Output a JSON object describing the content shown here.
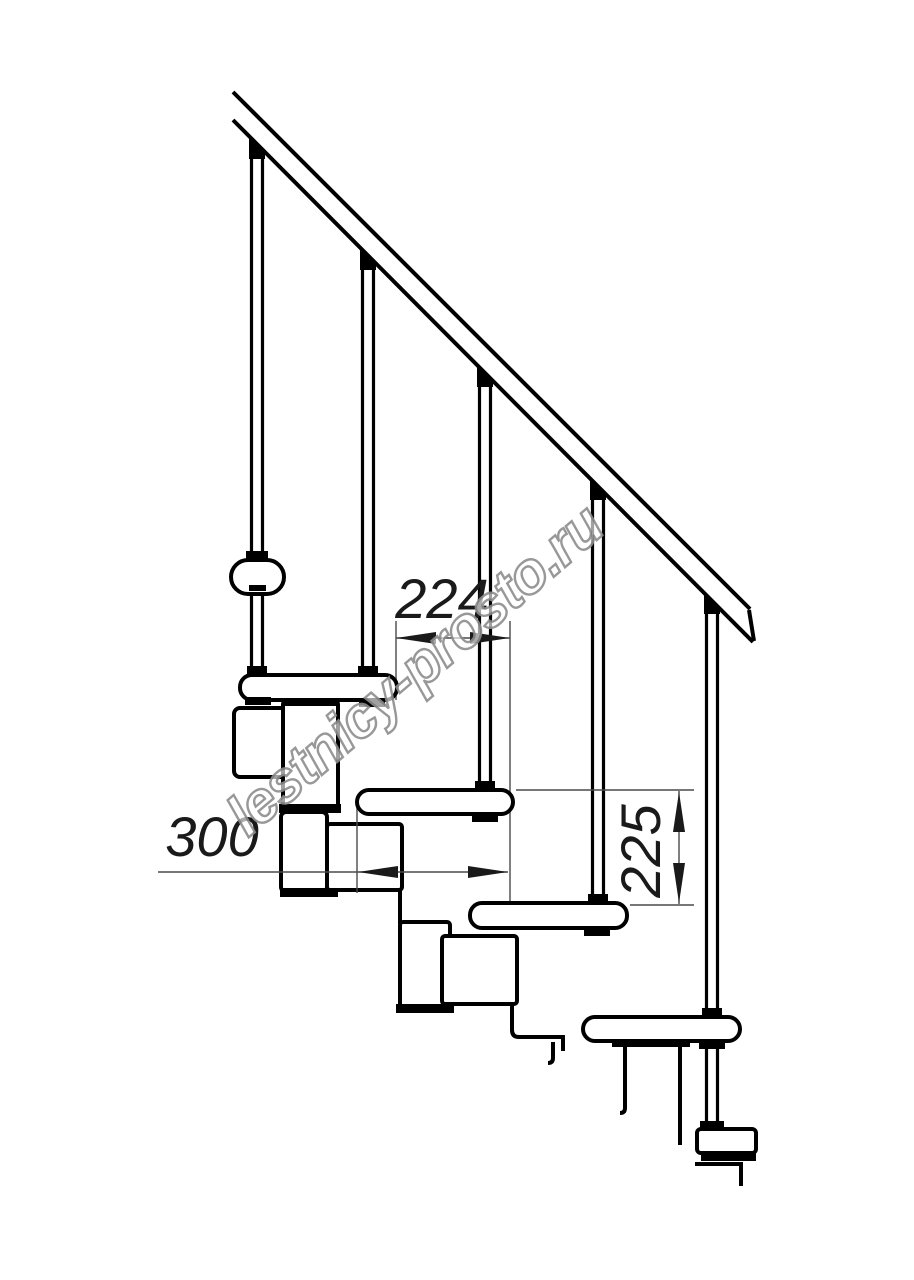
{
  "drawing": {
    "type": "technical line drawing",
    "subject": "modular staircase side elevation with handrail, balusters, treads and spine modules",
    "watermark": "lestnicy-prosto.ru",
    "dimensions": {
      "tread_run": {
        "value": "224",
        "orientation": "horizontal"
      },
      "tread_depth": {
        "value": "300",
        "orientation": "horizontal"
      },
      "riser_height": {
        "value": "225",
        "orientation": "vertical"
      }
    },
    "counts": {
      "balusters": 5,
      "side_view_treads": 4,
      "end_view_treads": 2,
      "spine_modules": 6
    },
    "colors": {
      "line": "#000000",
      "dimension_line": "#4a4a4a",
      "dimension_text": "#1a1a1a",
      "watermark_stroke": "#8d8d8d",
      "watermark_fill": "#ffffff",
      "background": "#ffffff"
    }
  }
}
